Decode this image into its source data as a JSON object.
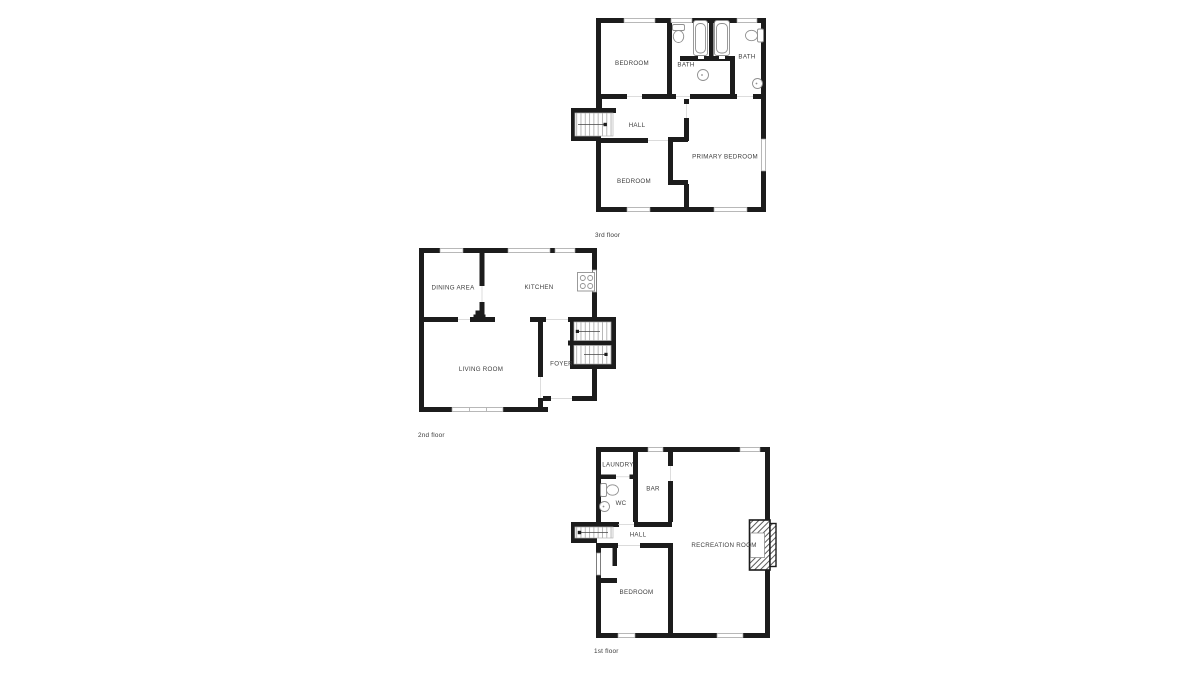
{
  "title": "House floor plans",
  "colors": {
    "background": "#ffffff",
    "wall": "#1c1c1c",
    "window_frame": "#9a9a9a",
    "fixture_outline": "#8f8f8f",
    "tread_border": "#b5b5b5",
    "threshold": "#cfcfcf",
    "text": "#3d3d3d",
    "caption_text": "#3a3a3a"
  },
  "floors": [
    {
      "caption": "3rd floor",
      "rooms": [
        {
          "label": "BEDROOM"
        },
        {
          "label": "BATH"
        },
        {
          "label": "BATH"
        },
        {
          "label": "HALL"
        },
        {
          "label": "BEDROOM"
        },
        {
          "label": "PRIMARY BEDROOM"
        }
      ],
      "fixtures": [
        "toilet-icon",
        "bathtub-icon",
        "bathtub-icon",
        "sink-icon",
        "toilet-icon",
        "sink-icon",
        "staircase"
      ]
    },
    {
      "caption": "2nd floor",
      "rooms": [
        {
          "label": "DINING AREA"
        },
        {
          "label": "KITCHEN"
        },
        {
          "label": "LIVING ROOM"
        },
        {
          "label": "FOYER"
        }
      ],
      "fixtures": [
        "stove-icon",
        "staircase",
        "door-leaf"
      ]
    },
    {
      "caption": "1st floor",
      "rooms": [
        {
          "label": "LAUNDRY"
        },
        {
          "label": "BAR"
        },
        {
          "label": "WC"
        },
        {
          "label": "HALL"
        },
        {
          "label": "RECREATION ROOM"
        },
        {
          "label": "BEDROOM"
        }
      ],
      "fixtures": [
        "toilet-icon",
        "sink-icon",
        "fireplace-icon",
        "staircase"
      ]
    }
  ]
}
